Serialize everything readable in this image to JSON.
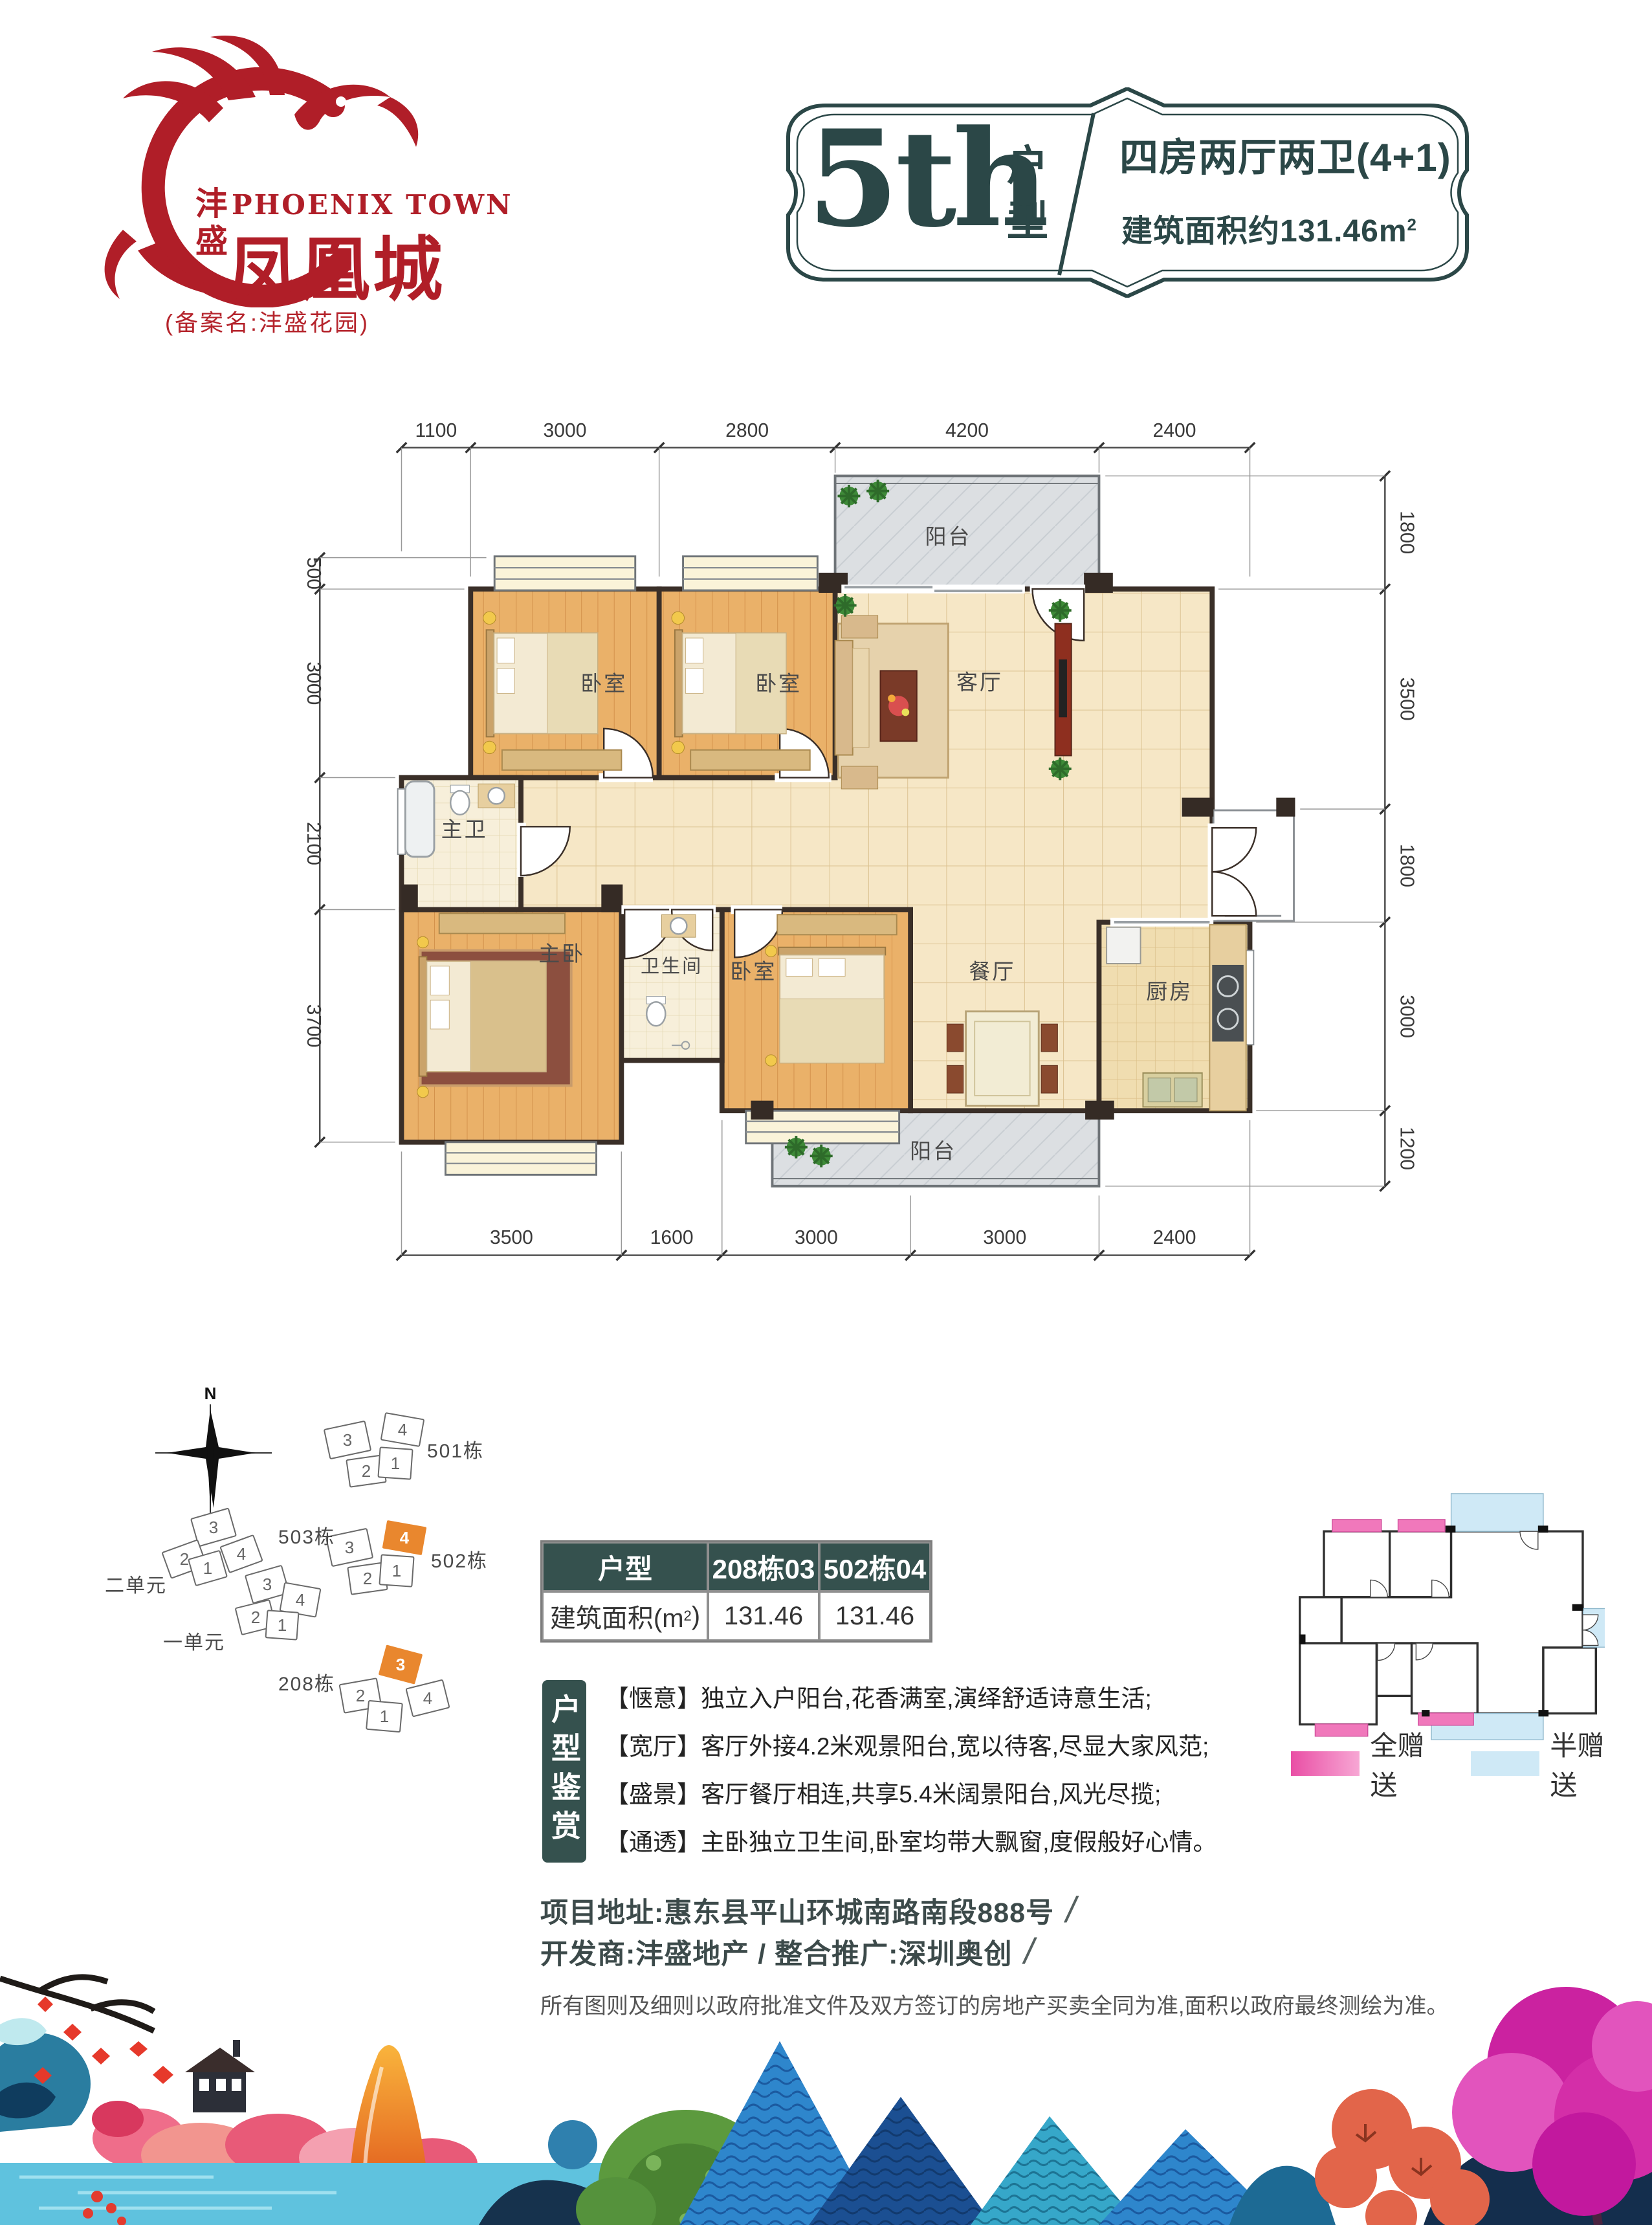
{
  "logo": {
    "brand_vertical": "沣盛",
    "brand_en": "PHOENIX TOWN",
    "brand_cn": "凤凰城",
    "registered_note": "(备案名:沣盛花园)"
  },
  "title": {
    "number": "5th",
    "unit_label": "户型",
    "layout": "四房两厅两卫(4+1)",
    "area_prefix": "建筑面积约131.46m",
    "area_sup": "2"
  },
  "floor_plan": {
    "dims_top": [
      "1100",
      "3000",
      "2800",
      "4200",
      "2400"
    ],
    "dims_bottom": [
      "3500",
      "1600",
      "3000",
      "3000",
      "2400"
    ],
    "dims_left": [
      "500",
      "3000",
      "2100",
      "3700"
    ],
    "dims_right": [
      "1800",
      "3500",
      "1800",
      "3000",
      "1200"
    ],
    "rooms": {
      "balcony_top": "阳台",
      "bedroom1": "卧室",
      "bedroom2": "卧室",
      "living": "客厅",
      "master_bath": "主卫",
      "master_bedroom": "主卧",
      "bathroom": "卫生间",
      "bedroom3": "卧室",
      "dining": "餐厅",
      "kitchen": "厨房",
      "balcony_bottom": "阳台"
    }
  },
  "site_plan": {
    "north": "N",
    "b501": {
      "label": "501栋",
      "units": [
        "3",
        "4",
        "2",
        "1"
      ]
    },
    "b502": {
      "label": "502栋",
      "units": [
        "3",
        "4",
        "2",
        "1"
      ]
    },
    "b503": {
      "label": "503栋",
      "unit2_label": "二单元",
      "unit1_label": "一单元",
      "units_upper": [
        "3",
        "2",
        "1",
        "4"
      ],
      "units_lower": [
        "3",
        "4",
        "2",
        "1"
      ]
    },
    "b208": {
      "label": "208栋",
      "units": [
        "3",
        "2",
        "1",
        "4"
      ]
    }
  },
  "table": {
    "col1": "户型",
    "col2": "208栋03",
    "col3": "502栋04",
    "row_label_prefix": "建筑面积(m",
    "row_label_sup": "2",
    "row_label_suffix": ")",
    "val1": "131.46",
    "val2": "131.46"
  },
  "appreciation": {
    "side_label": "户型鉴赏",
    "items": [
      "【惬意】独立入户阳台,花香满室,演绎舒适诗意生活;",
      "【宽厅】客厅外接4.2米观景阳台,宽以待客,尽显大家风范;",
      "【盛景】客厅餐厅相连,共享5.4米阔景阳台,风光尽揽;",
      "【通透】主卧独立卫生间,卧室均带大飘窗,度假般好心情。"
    ]
  },
  "gift_legend": {
    "full": "全赠送",
    "half": "半赠送"
  },
  "footer": {
    "address": "项目地址:惠东县平山环城南路南段888号",
    "developer": "开发商:沣盛地产 / 整合推广:深圳奥创",
    "slash": "/",
    "disclaimer": "所有图则及细则以政府批准文件及双方签订的房地产买卖全同为准,面积以政府最终测绘为准。"
  },
  "colors": {
    "brand_red": "#b01e28",
    "teal_dark": "#35514e",
    "highlight_orange": "#e9872e",
    "gift_pink": "#ee6fb5",
    "gift_blue": "#cfe9f6"
  }
}
